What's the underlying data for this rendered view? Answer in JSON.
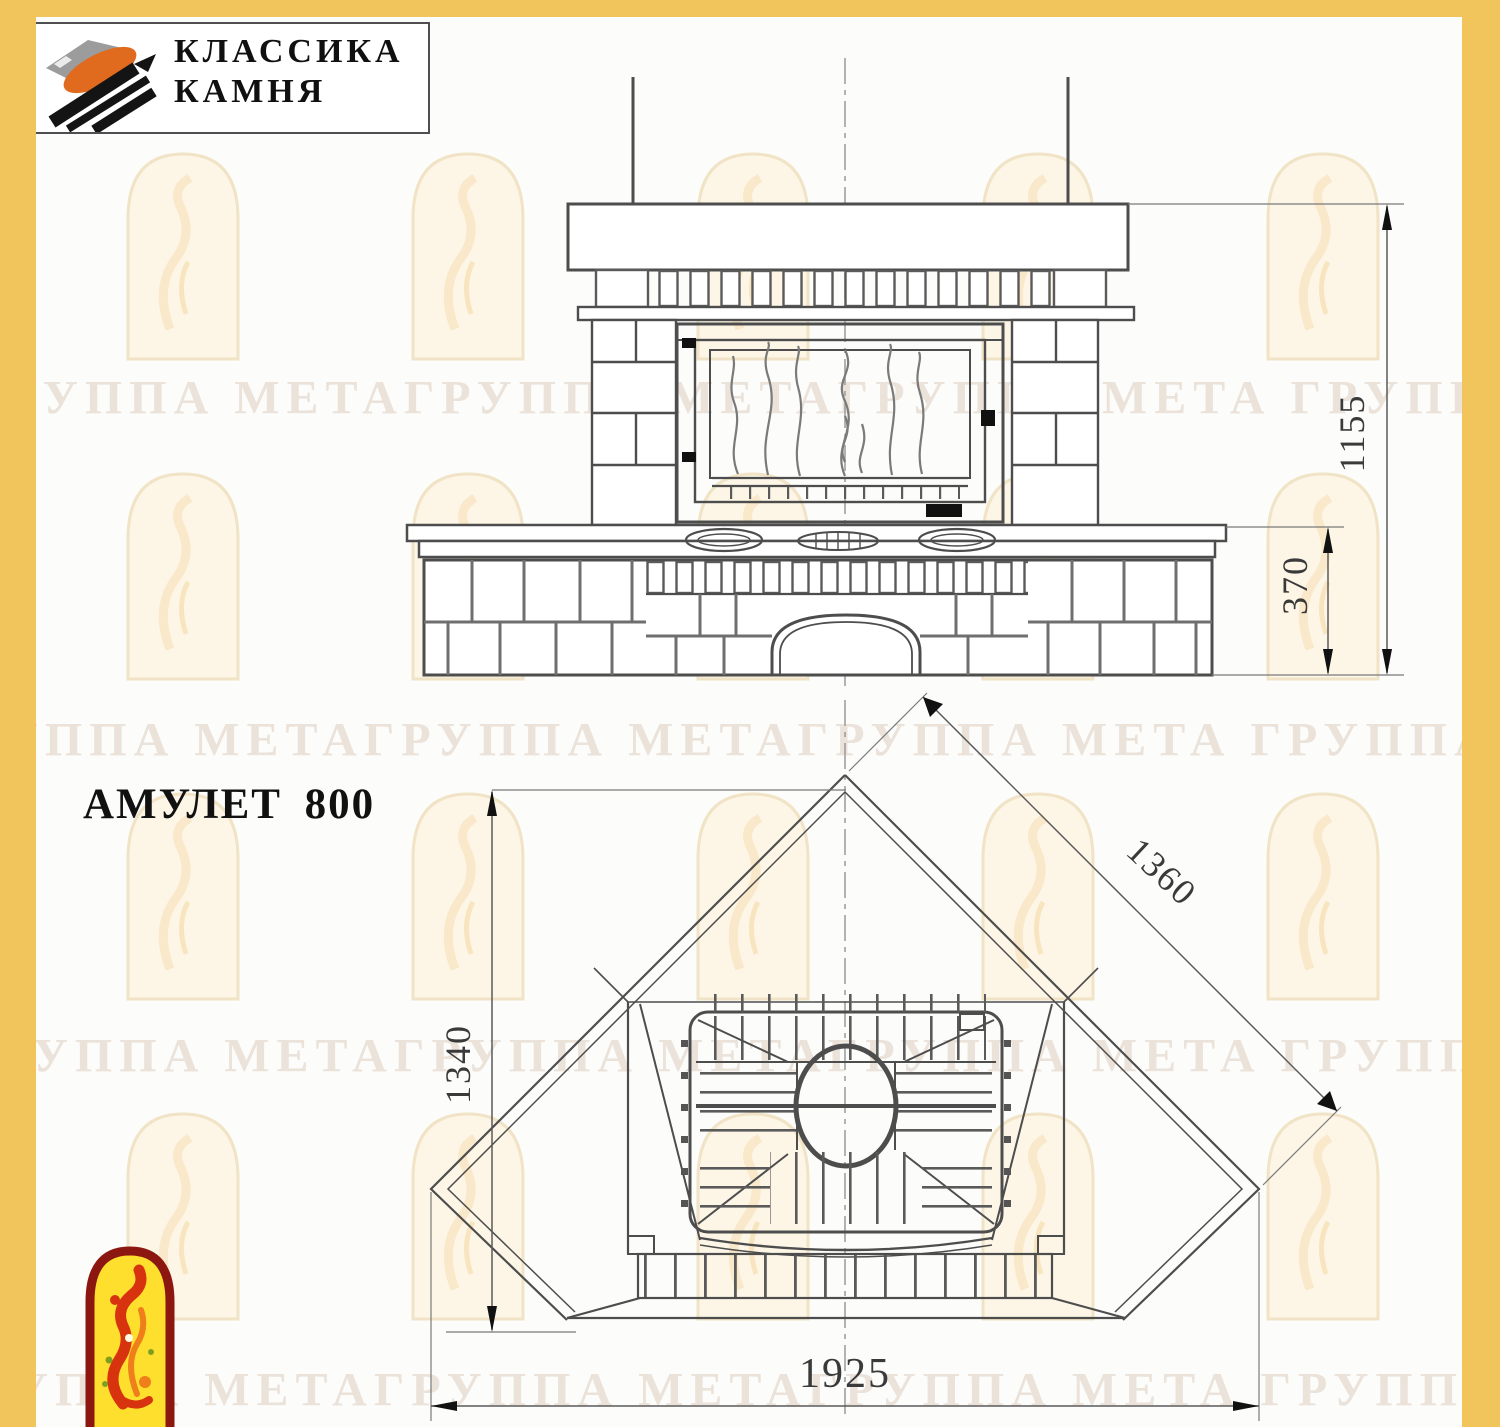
{
  "company_logo": {
    "line1": "КЛАССИКА",
    "line2": "КАМНЯ"
  },
  "title": "АМУЛЕТ 800",
  "watermark": {
    "text": "ГРУППА МЕТАГРУППА МЕТАГРУППА МЕТА ГРУППА МЕТАГРУППА"
  },
  "dimensions": {
    "overall_height_mm": "1155",
    "bench_height_mm": "370",
    "side_edge_mm": "1360",
    "corner_depth_mm": "1340",
    "overall_width_mm": "1925"
  },
  "colors": {
    "frame_yellow": "#F2C45C",
    "watermark_text": "#DCC9BC",
    "watermark_window_fill": "#FDF6E7",
    "watermark_window_stroke": "#F1E3C6",
    "drawing_line": "#4D4D4D",
    "logo_fire_yellow": "#FFDF2E",
    "logo_fire_red": "#8C1710",
    "logo_figure_red": "#D7330F",
    "logo_stone_orange": "#E06A1E"
  }
}
